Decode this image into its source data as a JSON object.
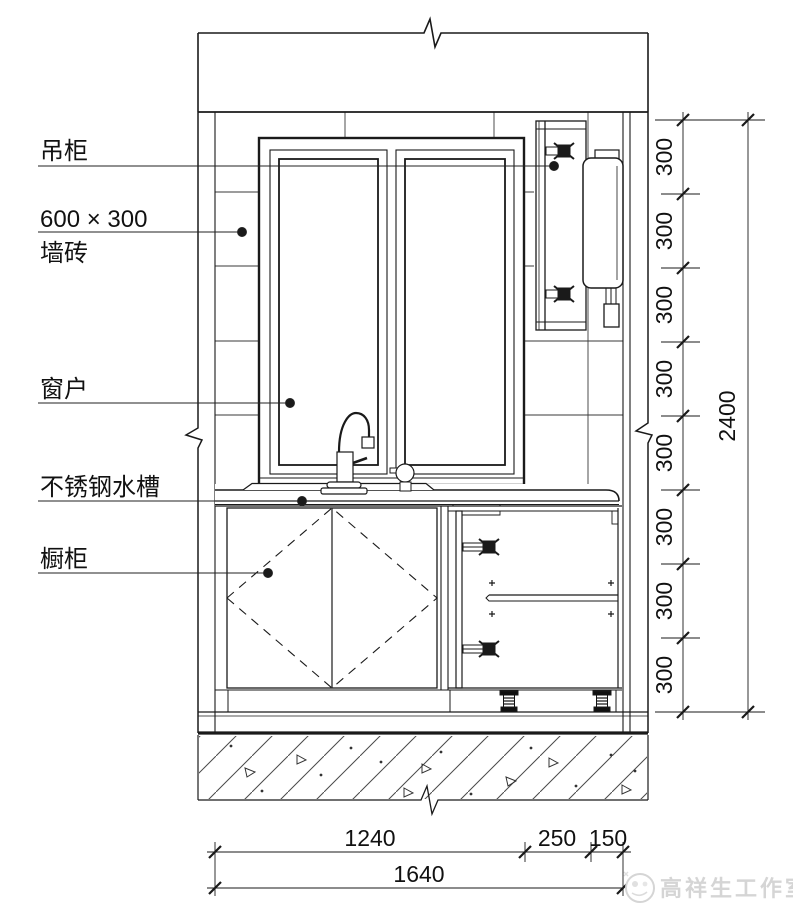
{
  "callouts": {
    "hanging_cabinet": "吊柜",
    "tile_size": "600 × 300",
    "tile_material": "墙砖",
    "window": "窗户",
    "sink": "不锈钢水槽",
    "base_cabinet": "橱柜"
  },
  "dims": {
    "right_chain": [
      "300",
      "300",
      "300",
      "300",
      "300",
      "300",
      "300",
      "300"
    ],
    "right_total": "2400",
    "bottom_chain": [
      "1240",
      "250",
      "150"
    ],
    "bottom_total": "1640"
  },
  "watermark": {
    "text": "高祥生工作室"
  },
  "colors": {
    "line": "#1a1a1a",
    "thin_line": "#3a3a3a",
    "watermark": "#d5d5d5"
  }
}
